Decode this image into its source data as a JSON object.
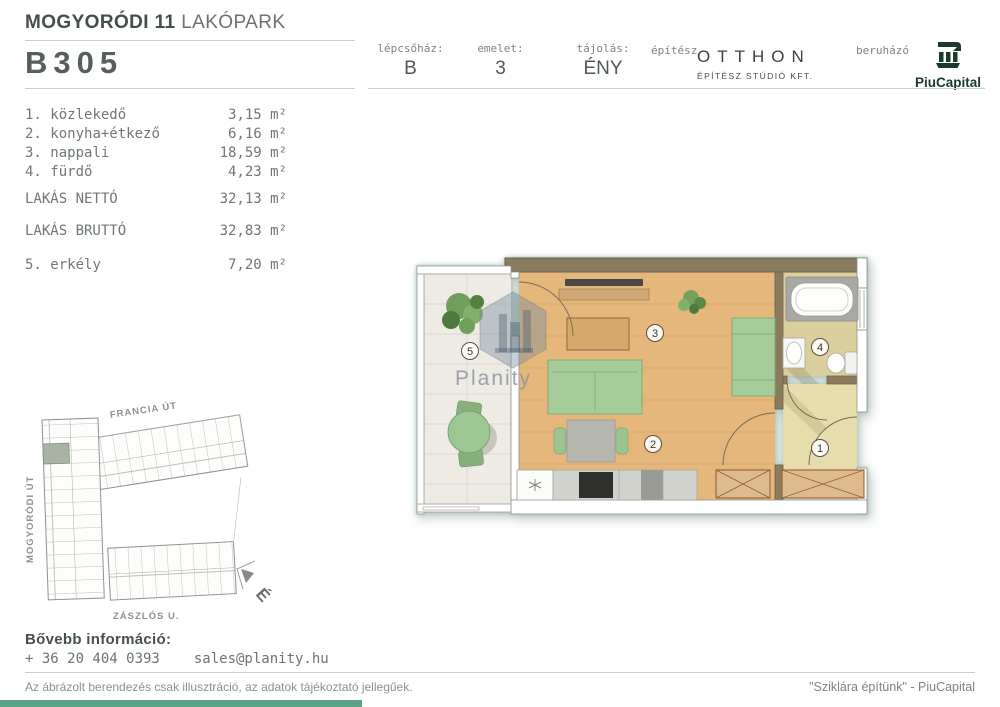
{
  "header": {
    "project_bold": "MOGYORÓDI 11",
    "project_light": " LAKÓPARK",
    "unit_id": "B305",
    "cells": [
      {
        "label": "lépcsőház:",
        "value": "B"
      },
      {
        "label": "emelet:",
        "value": "3"
      },
      {
        "label": "tájolás:",
        "value": "ÉNY"
      }
    ],
    "architect_label": "építész",
    "architect_name": "OTTHON",
    "architect_sub": "ÉPÍTÉSZ STÚDIÓ KFT.",
    "developer_label": "beruházó",
    "developer_name": "PiuCapital"
  },
  "room_list": {
    "rooms": [
      {
        "num": "1.",
        "name": "közlekedő",
        "value": "3,15 m²"
      },
      {
        "num": "2.",
        "name": "konyha+étkező",
        "value": "6,16 m²"
      },
      {
        "num": "3.",
        "name": "nappali",
        "value": "18,59 m²"
      },
      {
        "num": "4.",
        "name": "fürdő",
        "value": "4,23 m²"
      }
    ],
    "net_label": "LAKÁS NETTÓ",
    "net_value": "32,13 m²",
    "gross_label": "LAKÁS BRUTTÓ",
    "gross_value": "32,83 m²",
    "extra_num": "5.",
    "extra_name": "erkély",
    "extra_value": "7,20 m²"
  },
  "floor_plan": {
    "watermark": "Planity",
    "markers": {
      "balcony": "5",
      "living": "3",
      "bath": "4",
      "dining": "2",
      "hall": "1"
    }
  },
  "site_plan": {
    "street_top": "FRANCIA ÚT",
    "street_left": "MOGYORÓDI ÚT",
    "street_bottom": "ZÁSZLÓS U.",
    "compass": "É"
  },
  "contact": {
    "heading": "Bővebb információ:",
    "phone": "+ 36 20 404 0393",
    "email": "sales@planity.hu"
  },
  "footer": {
    "disclaimer": "Az ábrázolt berendezés csak illusztráció, az adatok tájékoztató jellegűek.",
    "slogan": "\"Sziklára építünk\" - PiuCapital"
  },
  "colors": {
    "accent_bar": "#5aa386",
    "wood_floor": "#e5b77a",
    "bath_floor": "#dbcf9e",
    "hall_floor": "#e7dcab",
    "wall_brown": "#8a7a5e",
    "sofa_green": "#a5cc99",
    "logo_green": "#1c3a2b",
    "text_gray": "#6f7872"
  }
}
